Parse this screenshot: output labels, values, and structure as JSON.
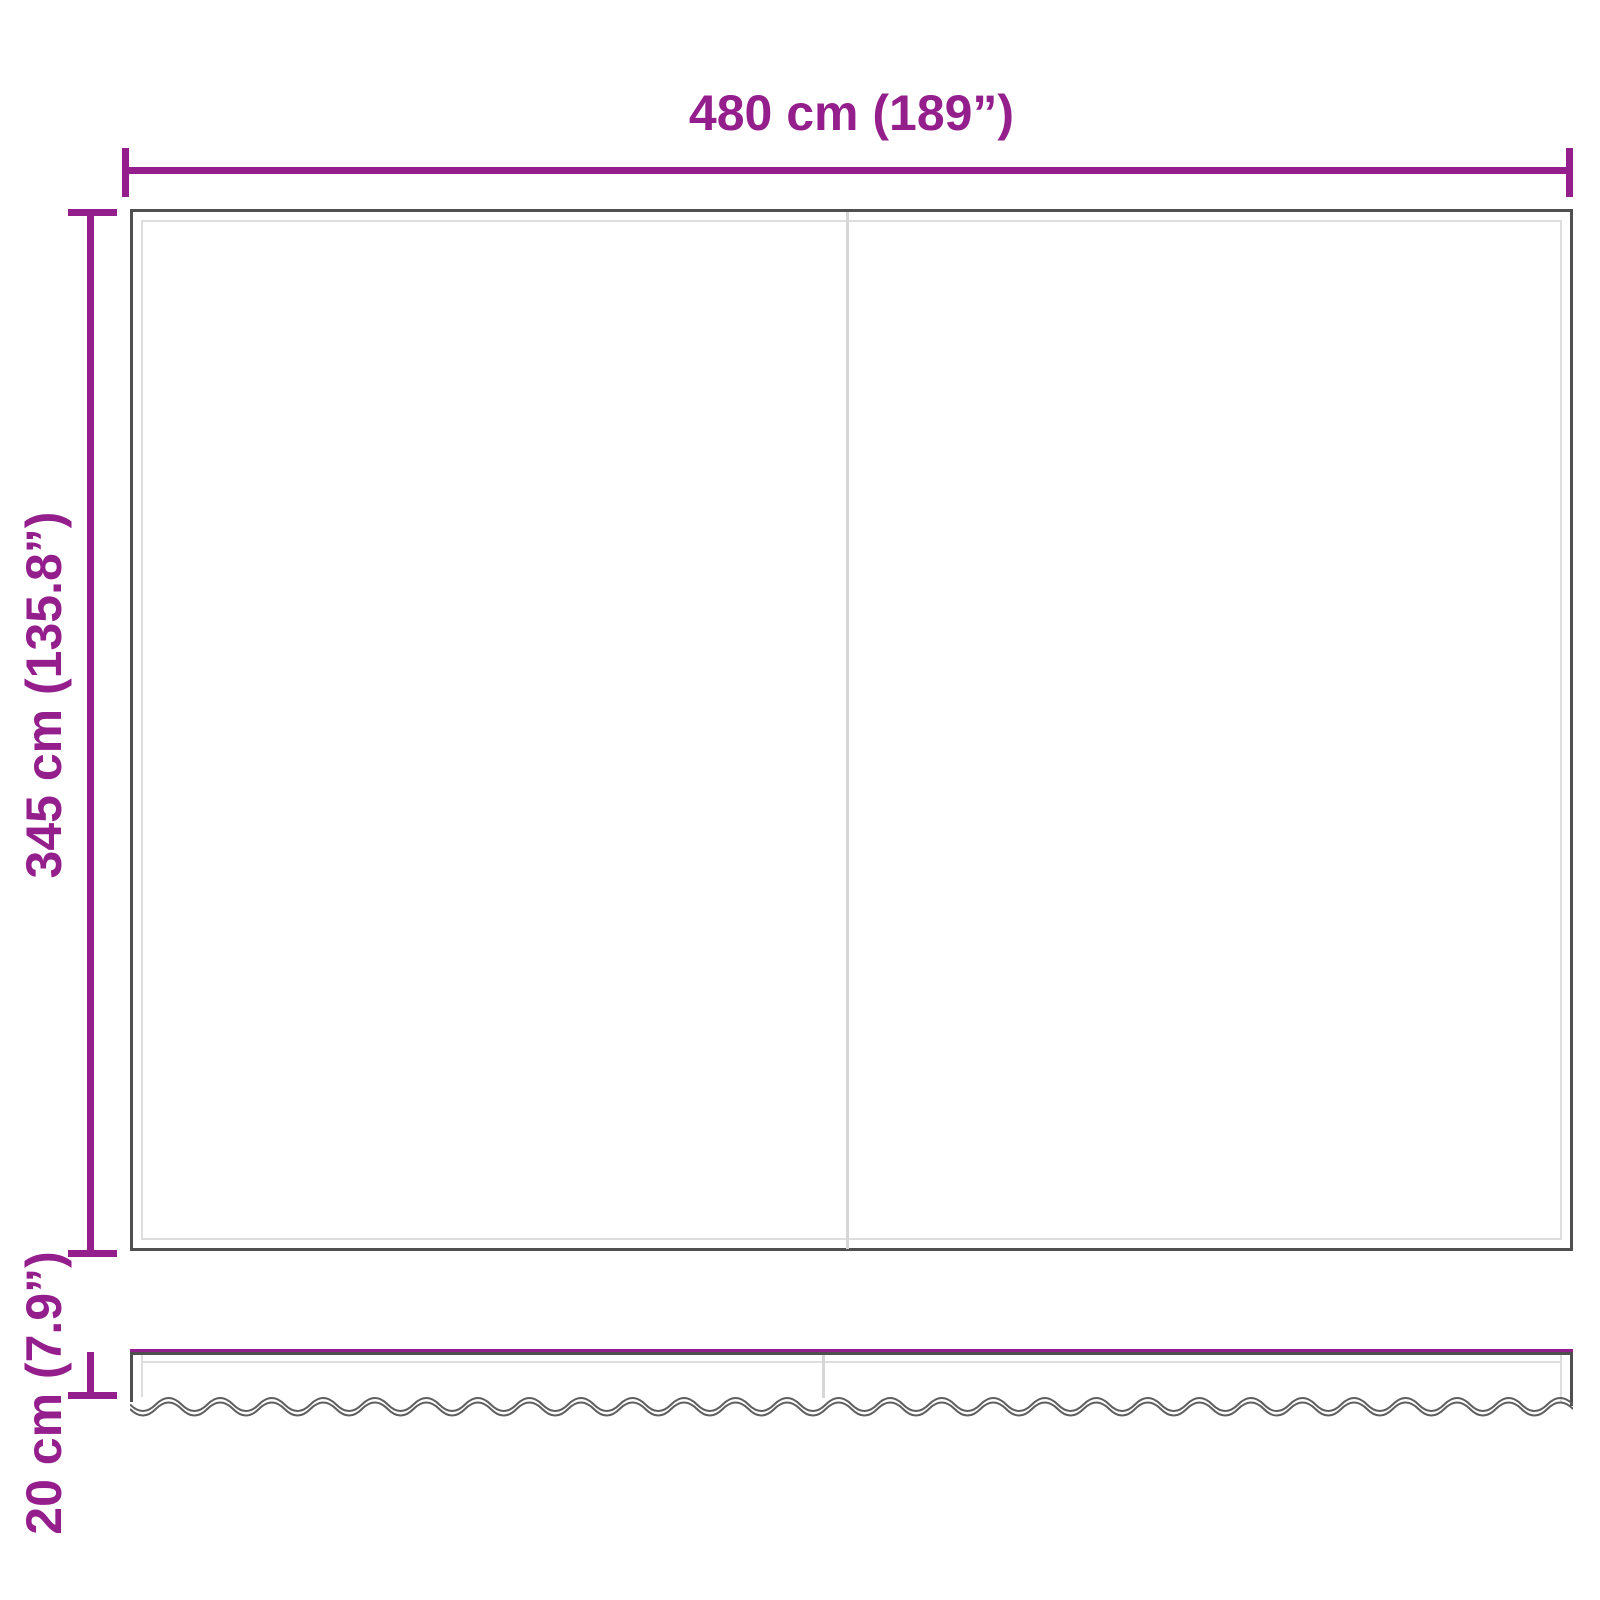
{
  "diagram": {
    "kind": "product-dimension-diagram",
    "views": {
      "front_panel": "awning-replacement-fabric",
      "bottom_strip": "scalloped-valance"
    }
  },
  "dimensions": {
    "width_label": "480 cm (189”)",
    "height_label": "345 cm (135.8”)",
    "valance_label": "20 cm (7.9”)"
  },
  "colors": {
    "accent": "#941E8C",
    "outline_dark": "#4F4F4F",
    "outline_light": "#DDDDDD",
    "divider": "#D6D6D6",
    "background": "#FFFFFF"
  }
}
